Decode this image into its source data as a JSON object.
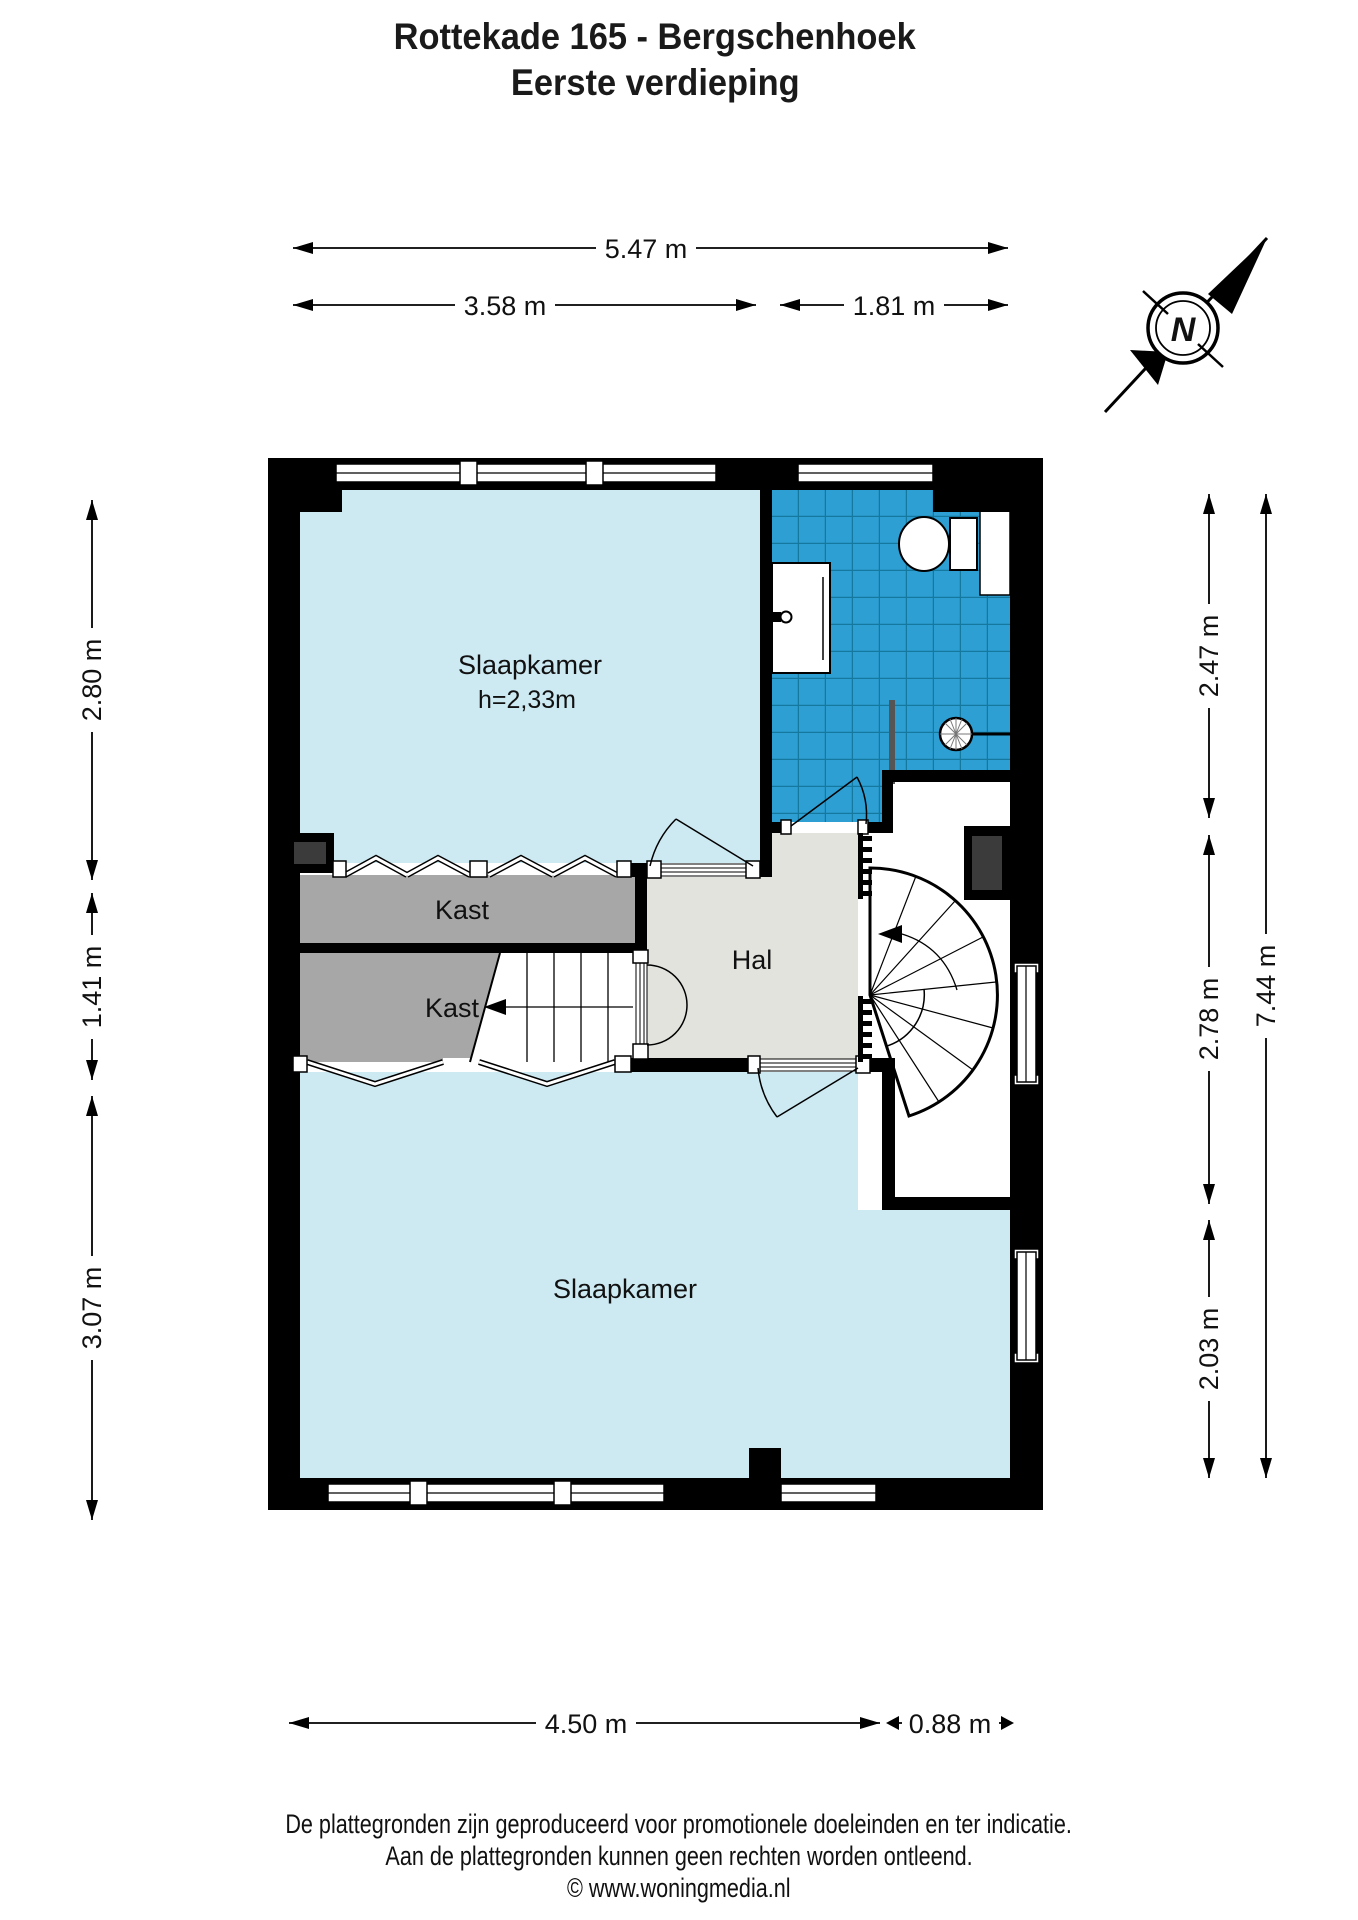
{
  "title": {
    "line1": "Rottekade 165 - Bergschenhoek",
    "line2": "Eerste verdieping"
  },
  "compass": {
    "north_label": "N"
  },
  "rooms": {
    "bedroom1": {
      "name": "Slaapkamer",
      "height_note": "h=2,33m"
    },
    "bedroom2": {
      "name": "Slaapkamer"
    },
    "hall": {
      "name": "Hal"
    },
    "closet_upper": {
      "name": "Kast"
    },
    "closet_lower": {
      "name": "Kast"
    }
  },
  "dimensions": {
    "top": [
      {
        "label": "5.47 m"
      },
      {
        "label": "3.58 m"
      },
      {
        "label": "1.81 m"
      }
    ],
    "left": [
      {
        "label": "2.80 m"
      },
      {
        "label": "1.41 m"
      },
      {
        "label": "3.07 m"
      }
    ],
    "right": [
      {
        "label": "2.47 m"
      },
      {
        "label": "2.78 m"
      },
      {
        "label": "2.03 m"
      },
      {
        "label": "7.44 m"
      }
    ],
    "bottom": [
      {
        "label": "4.50 m"
      },
      {
        "label": "0.88 m"
      }
    ]
  },
  "footer": {
    "line1": "De plattegronden zijn geproduceerd voor promotionele doeleinden en ter indicatie.",
    "line2": "Aan de plattegronden kunnen geen rechten worden ontleend.",
    "line3": "© www.woningmedia.nl"
  },
  "colors": {
    "room_fill": "#cde9f2",
    "tile_fill": "#2d9fd2",
    "tile_grid": "#15789e",
    "closet_fill": "#a7a7a7",
    "hall_fill": "#e3e3de",
    "wall": "#000000",
    "shaft_fill": "#3b3b3b"
  }
}
